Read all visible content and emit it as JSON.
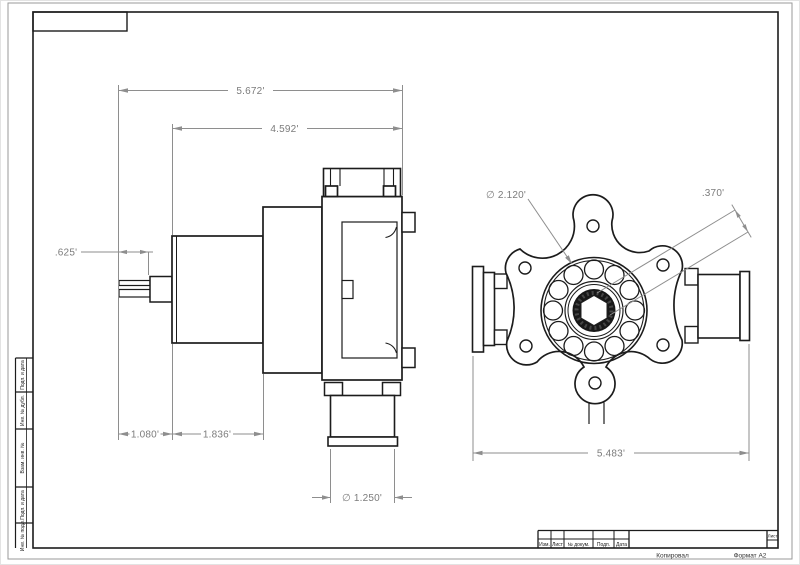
{
  "dims": {
    "overall": "5.672'",
    "body": "4.592'",
    "terminal": ".625'",
    "offset": "1.080'",
    "motor": "1.836'",
    "outlet": "∅ 1.250'",
    "boss": "∅ 2.120'",
    "hex": ".370'",
    "endwidth": "5.483'"
  },
  "title_block": {
    "col_izm": "Изм.",
    "col_list": "Лист",
    "col_doc": "№ докум.",
    "col_podp": "Подп.",
    "col_data": "Дата",
    "sheet_cell": "Лист"
  },
  "margin_fields": {
    "f1": "Подп. и дата",
    "f2": "Инв. № дубл.",
    "f3": "Взам. инв. №",
    "f4": "Подп. и дата",
    "f5": "Инв. № подл."
  },
  "footer": {
    "left": "Копировал",
    "right": "Формат А2"
  }
}
